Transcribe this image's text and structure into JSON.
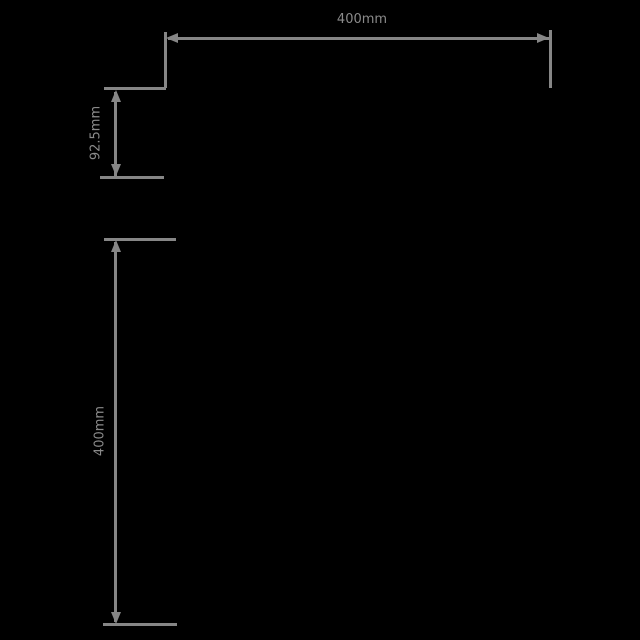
{
  "diagram": {
    "type": "technical-dimension-drawing",
    "background_color": "#000000",
    "line_color": "#868686",
    "text_color": "#8a8a8a",
    "dimensions": {
      "top_width": {
        "label": "400mm",
        "orientation": "horizontal"
      },
      "upper_left_height": {
        "label": "92.5mm",
        "orientation": "vertical"
      },
      "lower_left_height": {
        "label": "400mm",
        "orientation": "vertical"
      }
    }
  }
}
